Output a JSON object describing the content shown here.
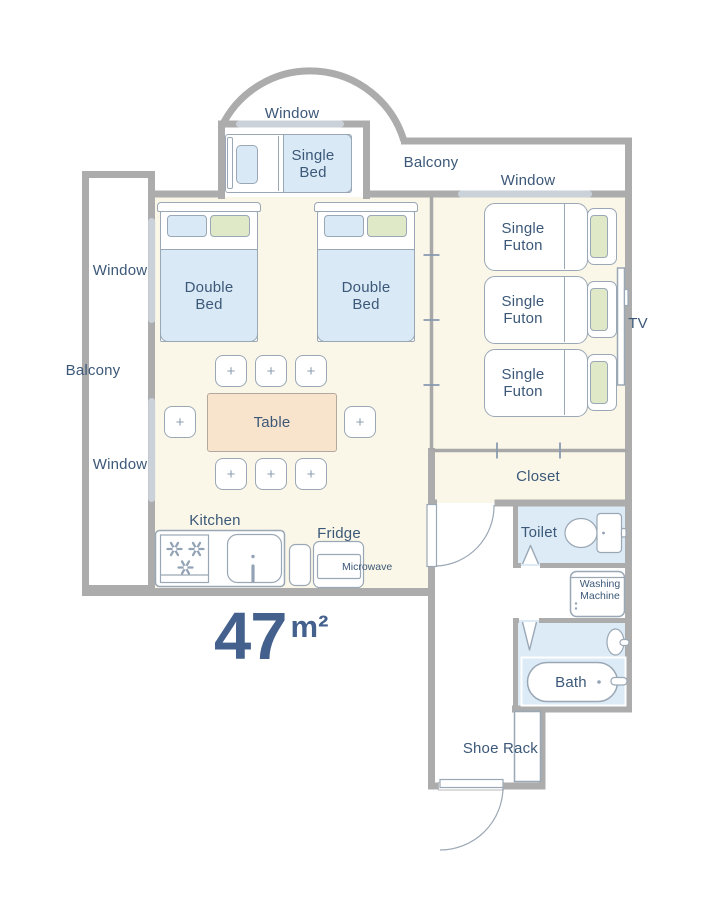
{
  "area": {
    "value": "47",
    "unit": "m²"
  },
  "labels": {
    "window": "Window",
    "balcony": "Balcony",
    "single_bed": "Single Bed",
    "double_bed": "Double Bed",
    "single_futon": "Single Futon",
    "table": "Table",
    "kitchen": "Kitchen",
    "fridge": "Fridge",
    "microwave": "Microwave",
    "closet": "Closet",
    "toilet": "Toilet",
    "washing_machine": "Washing Machine",
    "bath": "Bath",
    "shoe_rack": "Shoe Rack",
    "tv": "TV",
    "chair_mark": "+"
  },
  "colors": {
    "wall": "#acacac",
    "floor": "#faf7e8",
    "wet_room": "#dcebf6",
    "bedding_blue": "#d9eaf6",
    "pillow_green": "#dfe9c8",
    "table_peach": "#f8e3cc",
    "outline": "#9aa7b5",
    "window_bar": "#cbd1d9",
    "text": "#3c5878",
    "area_text": "#44608c"
  }
}
